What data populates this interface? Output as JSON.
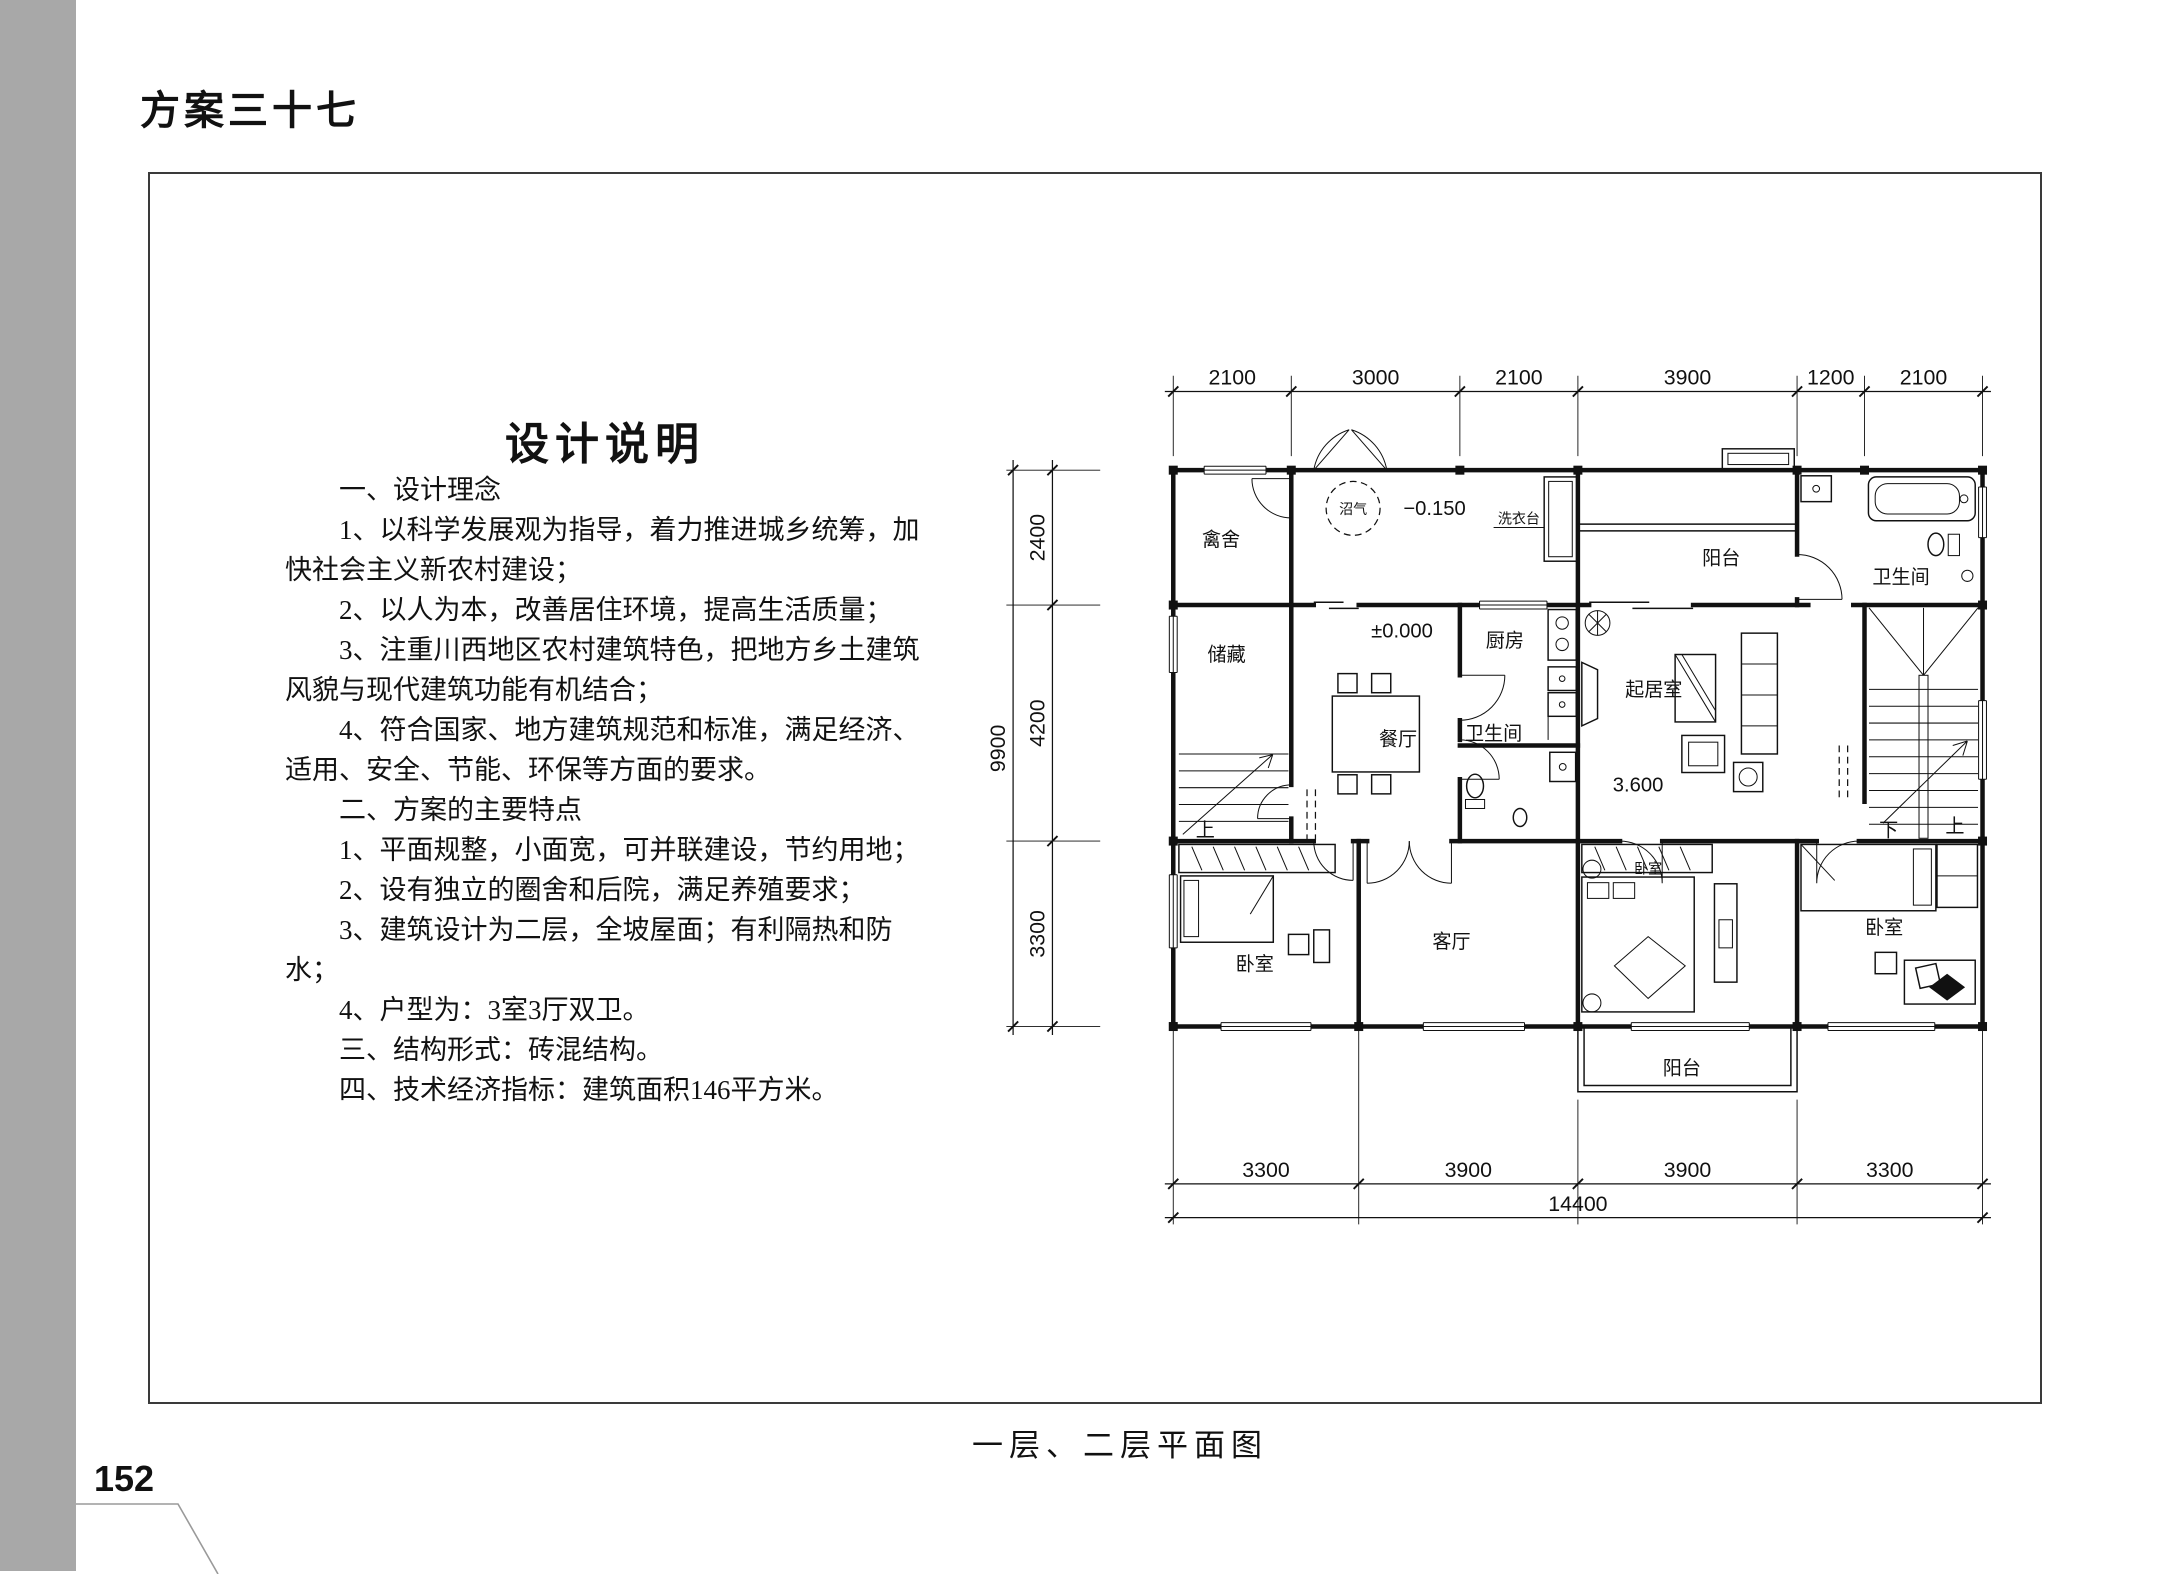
{
  "page": {
    "title": "方案三十七",
    "number": "152",
    "caption": "一层、二层平面图"
  },
  "description": {
    "heading": "设计说明",
    "lines": [
      {
        "text": "一、设计理念"
      },
      {
        "text": "1、以科学发展观为指导，着力推进城乡统筹，加"
      },
      {
        "text": "快社会主义新农村建设；"
      },
      {
        "text": "2、以人为本，改善居住环境，提高生活质量；"
      },
      {
        "text": "3、注重川西地区农村建筑特色，把地方乡土建筑"
      },
      {
        "text": "风貌与现代建筑功能有机结合；"
      },
      {
        "text": "4、符合国家、地方建筑规范和标准，满足经济、"
      },
      {
        "text": "适用、安全、节能、环保等方面的要求。"
      },
      {
        "text": "二、方案的主要特点"
      },
      {
        "text": "1、平面规整，小面宽，可并联建设，节约用地；"
      },
      {
        "text": "2、设有独立的圈舍和后院，满足养殖要求；"
      },
      {
        "text": "3、建筑设计为二层，全坡屋面；有利隔热和防"
      },
      {
        "text": "水；"
      },
      {
        "text": "4、户型为：3室3厅双卫。"
      },
      {
        "text": "三、结构形式：砖混结构。"
      },
      {
        "text": "四、技术经济指标：建筑面积146平方米。"
      }
    ]
  },
  "plan": {
    "labels": {
      "qinshe": "禽舍",
      "chucang": "储藏",
      "canting": "餐厅",
      "chufang": "厨房",
      "weishengjian1": "卫生间",
      "weishengjian2": "卫生间",
      "qijushi": "起居室",
      "yangtai_top": "阳台",
      "yangtai_bottom": "阳台",
      "keting": "客厅",
      "woshi1": "卧室",
      "woshi2": "卧室",
      "woshi3": "卧室",
      "xiyitai": "洗衣台",
      "zhaoqi": "沼气",
      "up_left": "上",
      "down_right": "下",
      "up_right": "上"
    },
    "levels": {
      "yard": "−0.150",
      "ground": "±0.000",
      "upper": "3.600"
    },
    "dims": {
      "top": [
        "2100",
        "3000",
        "2100",
        "3900",
        "1200",
        "2100"
      ],
      "left": [
        "2400",
        "4200",
        "3300"
      ],
      "left_total": "9900",
      "bottom": [
        "3300",
        "3900",
        "3900",
        "3300"
      ],
      "bottom_total": "14400"
    }
  }
}
